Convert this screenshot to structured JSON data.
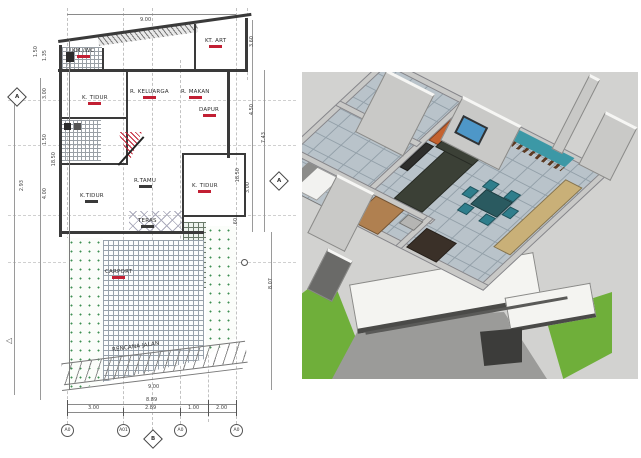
{
  "plan": {
    "rooms": [
      {
        "label": "KM./WC",
        "underline": "u-red"
      },
      {
        "label": "KT. ART",
        "underline": "u-red"
      },
      {
        "label": "K. TIDUR",
        "underline": "u-red"
      },
      {
        "label": "R. KELUARGA",
        "underline": "u-red"
      },
      {
        "label": "R. MAKAN",
        "underline": "u-red"
      },
      {
        "label": "DAPUR",
        "underline": "u-red"
      },
      {
        "label": "K.TIDUR",
        "underline": "u-dark"
      },
      {
        "label": "R.TAMU",
        "underline": "u-dark"
      },
      {
        "label": "K. TIDUR",
        "underline": "u-red"
      },
      {
        "label": "TERAS",
        "underline": "u-dark"
      },
      {
        "label": "CARPORT",
        "underline": "u-red"
      },
      {
        "label": "RENCANA JALAN",
        "underline": null
      }
    ],
    "dims": {
      "top": "9.00",
      "left": [
        "1.50",
        "1.35",
        "3.00",
        "1.50",
        "18.50",
        "2.93",
        "4.00"
      ],
      "right": [
        "3.60",
        "4.50",
        "7.43",
        "18.50",
        "3.00",
        ".60",
        "8.07"
      ],
      "bottom_total": "8.89",
      "bottom_segments": [
        "3.00",
        "2.89",
        "1.00",
        "2.00"
      ],
      "road_width": "9.00"
    },
    "grid_bubbles": [
      "A0",
      "A01",
      "A0",
      "A0"
    ],
    "markers": {
      "left": "A",
      "right": "A",
      "bottom": "B",
      "west_arrow": "◁"
    },
    "colors": {
      "line": "#3a3a3a",
      "label_red": "#c21f33",
      "paper": "#ffffff",
      "garden_dot": "#3e8e52"
    }
  },
  "render3d": {
    "colors": {
      "background": "#d2d2d0",
      "wall": "#c9c9c7",
      "wall_top": "#f6f6f4",
      "tile": "#b9c3ca",
      "grout": "#93a0a9",
      "grass": "#6faf3a",
      "driveway": "#9b9b99",
      "slab": "#f4f4f1",
      "sofa": "#3b4036",
      "chair": "#2f7e8c",
      "table": "#2a5a60",
      "counter": "#c9b078",
      "wood": "#b08050",
      "accent_orange": "#c4622f",
      "water": "#3c98a6",
      "deck": "#5c3a22",
      "window": "#4e97c8",
      "bed_dark": "#3a3028",
      "tv": "#2e2e2c"
    }
  }
}
